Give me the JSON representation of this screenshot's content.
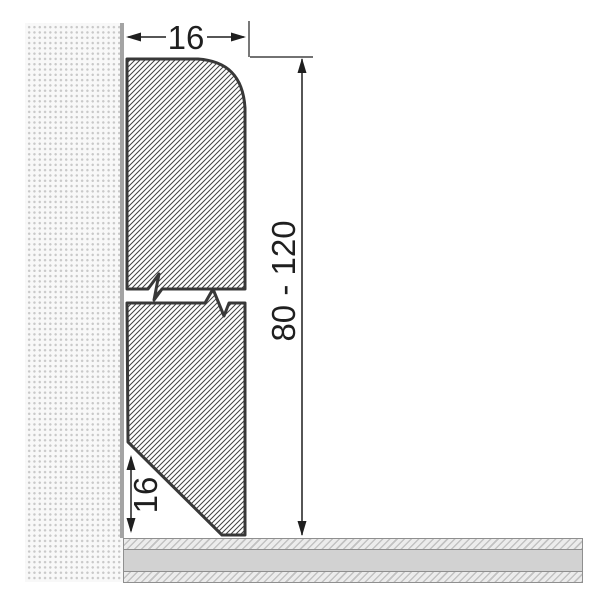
{
  "drawing": {
    "subject": "skirting-board-profile-cross-section",
    "labels": {
      "width": "16",
      "height_range": "80 - 120",
      "chamfer": "16"
    },
    "colors": {
      "profile_outline": "#383838",
      "profile_hatch": "#424242",
      "dimension_ink": "#1f1f1f",
      "wall_background": "#f8f8f8",
      "wall_stipple": "#c9c9c9",
      "wall_surface": "#a4a4a4",
      "floor_border": "#8f8f8f",
      "floor_core": "#d2d2d2",
      "floor_hatch_background": "#ececec",
      "floor_hatch_line": "#c2c2c2"
    }
  }
}
